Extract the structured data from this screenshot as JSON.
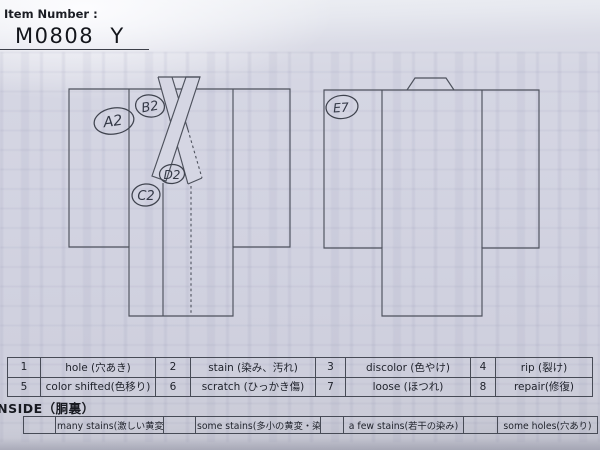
{
  "header": {
    "label": "Item Number :",
    "value": "M0808  Y"
  },
  "circles": {
    "a2": "A2",
    "b2": "B2",
    "c2": "C2",
    "d2": "D2",
    "e7": "E7"
  },
  "legend_table": {
    "rows": [
      [
        {
          "num": "1",
          "label": "hole (穴あき)"
        },
        {
          "num": "2",
          "label": "stain (染み、汚れ)"
        },
        {
          "num": "3",
          "label": "discolor (色やけ)"
        },
        {
          "num": "4",
          "label": "rip (裂け)"
        }
      ],
      [
        {
          "num": "5",
          "label": "color shifted(色移り)"
        },
        {
          "num": "6",
          "label": "scratch (ひっかき傷)"
        },
        {
          "num": "7",
          "label": "loose (ほつれ)"
        },
        {
          "num": "8",
          "label": "repair(修復)"
        }
      ]
    ]
  },
  "inside": {
    "heading": "INSIDE（胴裏）",
    "options": [
      {
        "label": "many stains(激しい黄変・染み)"
      },
      {
        "label": "some stains(多小の黄変・染み)"
      },
      {
        "label": "a few stains(若干の染み)"
      },
      {
        "label": "some holes(穴あり)"
      }
    ]
  },
  "colors": {
    "paper": "#d2d3e1",
    "ink": "#1e212a",
    "line": "#4d515c"
  }
}
